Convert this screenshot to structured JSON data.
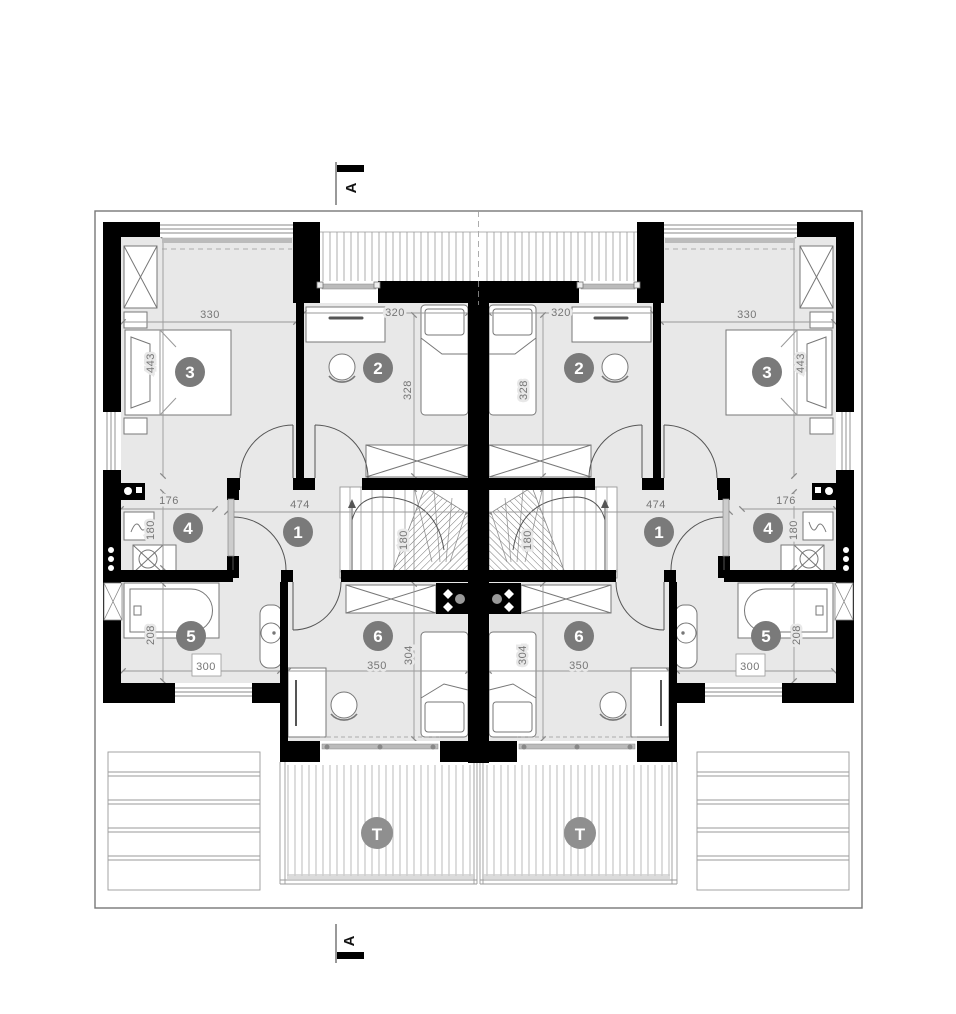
{
  "drawing_type": "architectural-floor-plan",
  "section_markers": {
    "top_label": "A",
    "bottom_label": "A"
  },
  "room_markers": {
    "r1": "1",
    "r2": "2",
    "r3": "3",
    "r4": "4",
    "r5": "5",
    "r6": "6",
    "terrace": "T"
  },
  "dimensions": {
    "d330": "330",
    "d443": "443",
    "d320": "320",
    "d328": "328",
    "d474": "474",
    "d180_stairs": "180",
    "d176": "176",
    "d180_room4": "180",
    "d208": "208",
    "d300": "300",
    "d350": "350",
    "d304": "304"
  },
  "colors": {
    "wall": "#000000",
    "room_fill": "#e8e8e8",
    "marker_fill": "#7a7a7a",
    "terrace_marker_fill": "#8f8f8f",
    "line": "#999999",
    "dim_text": "#767676"
  }
}
